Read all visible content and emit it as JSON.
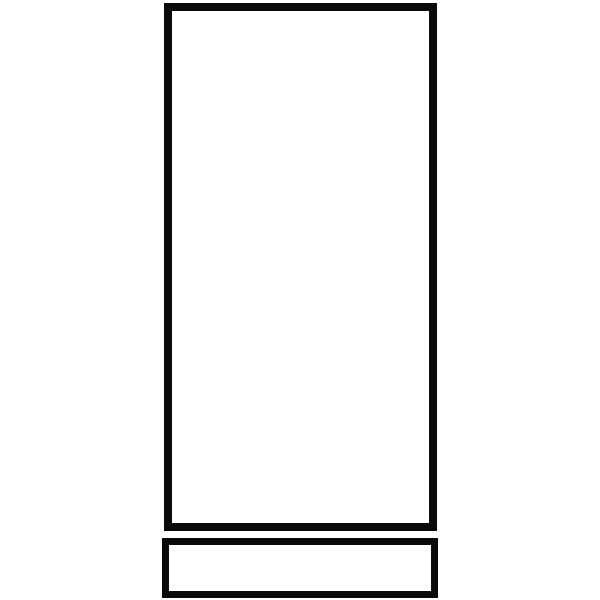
{
  "canvas": {
    "width": 600,
    "height": 600,
    "background": "#ffffff"
  },
  "shapes": {
    "tall_rectangle": {
      "left": 164,
      "top": 3,
      "width": 273,
      "height": 528,
      "border_width": 8,
      "border_color": "#0a0a0a",
      "fill": "#ffffff"
    },
    "base_rectangle": {
      "left": 162,
      "top": 538,
      "width": 276,
      "height": 60,
      "border_width": 7,
      "border_color": "#0a0a0a",
      "fill": "#ffffff"
    }
  }
}
